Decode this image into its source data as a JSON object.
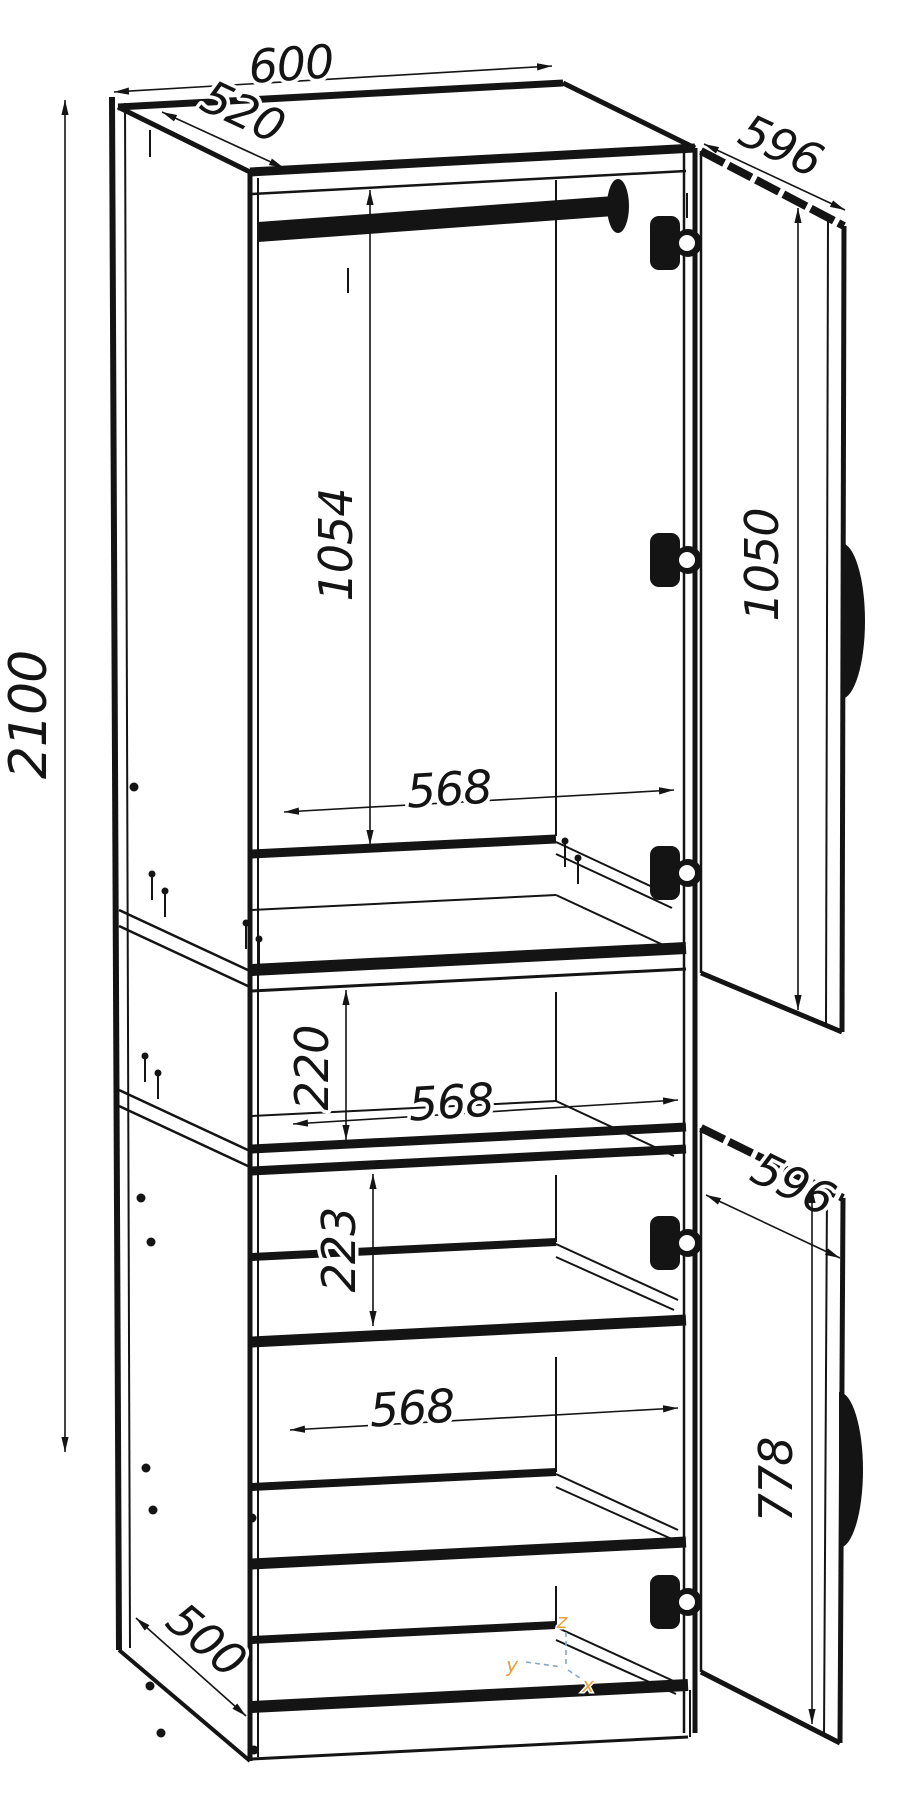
{
  "drawing": {
    "type": "furniture-assembly-dimension-diagram",
    "subject": "two-door tall wardrobe cabinet, isometric line drawing, doors open",
    "dimensions": {
      "total_height": "2100",
      "top_width": "600",
      "top_depth": "520",
      "upper_door_width": "596",
      "upper_door_height": "1050",
      "upper_interior_height": "1054",
      "upper_interior_width": "568",
      "niche_height": "220",
      "niche_width": "568",
      "lower_first_gap": "223",
      "lower_interior_width": "568",
      "lower_door_height": "778",
      "lower_door_width": "596",
      "base_depth": "500"
    },
    "axes": {
      "x": "x",
      "y": "y",
      "z": "z"
    },
    "colors": {
      "line": "#141414",
      "background": "#ffffff",
      "axis_label": "#E8A23B",
      "axis_line": "#86A8C8"
    }
  }
}
